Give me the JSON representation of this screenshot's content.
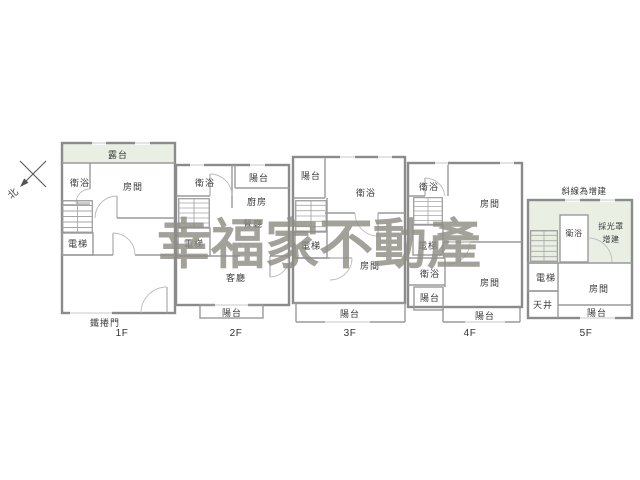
{
  "compass": {
    "north": "北"
  },
  "watermark": {
    "text": "幸福家不動產",
    "color": "#8f8d84"
  },
  "note": {
    "extension": "斜線為增建"
  },
  "floor1": {
    "label": "1F",
    "terrace": "露台",
    "bath": "衛浴",
    "room": "房間",
    "elevator": "電梯",
    "rolling_door": "鐵捲門"
  },
  "floor2": {
    "label": "2F",
    "bath": "衛浴",
    "balcony_top": "陽台",
    "kitchen": "廚房",
    "dining": "餐廳",
    "elevator": "電梯",
    "living": "客廳",
    "balcony_bottom": "陽台"
  },
  "floor3": {
    "label": "3F",
    "balcony_top": "陽台",
    "bath": "衛浴",
    "elevator": "電梯",
    "room": "房間",
    "balcony_bottom": "陽台"
  },
  "floor4": {
    "label": "4F",
    "bath_top": "衛浴",
    "room_top": "房間",
    "elevator": "電梯",
    "bath_mid": "衛浴",
    "balcony_left": "陽台",
    "room_bottom": "房間",
    "balcony_bottom": "陽台"
  },
  "floor5": {
    "label": "5F",
    "bath": "衛浴",
    "skylight_1": "採光罩",
    "skylight_2": "增建",
    "elevator": "電梯",
    "lightwell": "天井",
    "room": "房間",
    "balcony": "陽台"
  },
  "colors": {
    "wall": "#8b8b8b",
    "extension_fill": "#eaefe4",
    "label_text": "#3a3a3a",
    "watermark": "#8f8d84",
    "background": "#ffffff"
  }
}
